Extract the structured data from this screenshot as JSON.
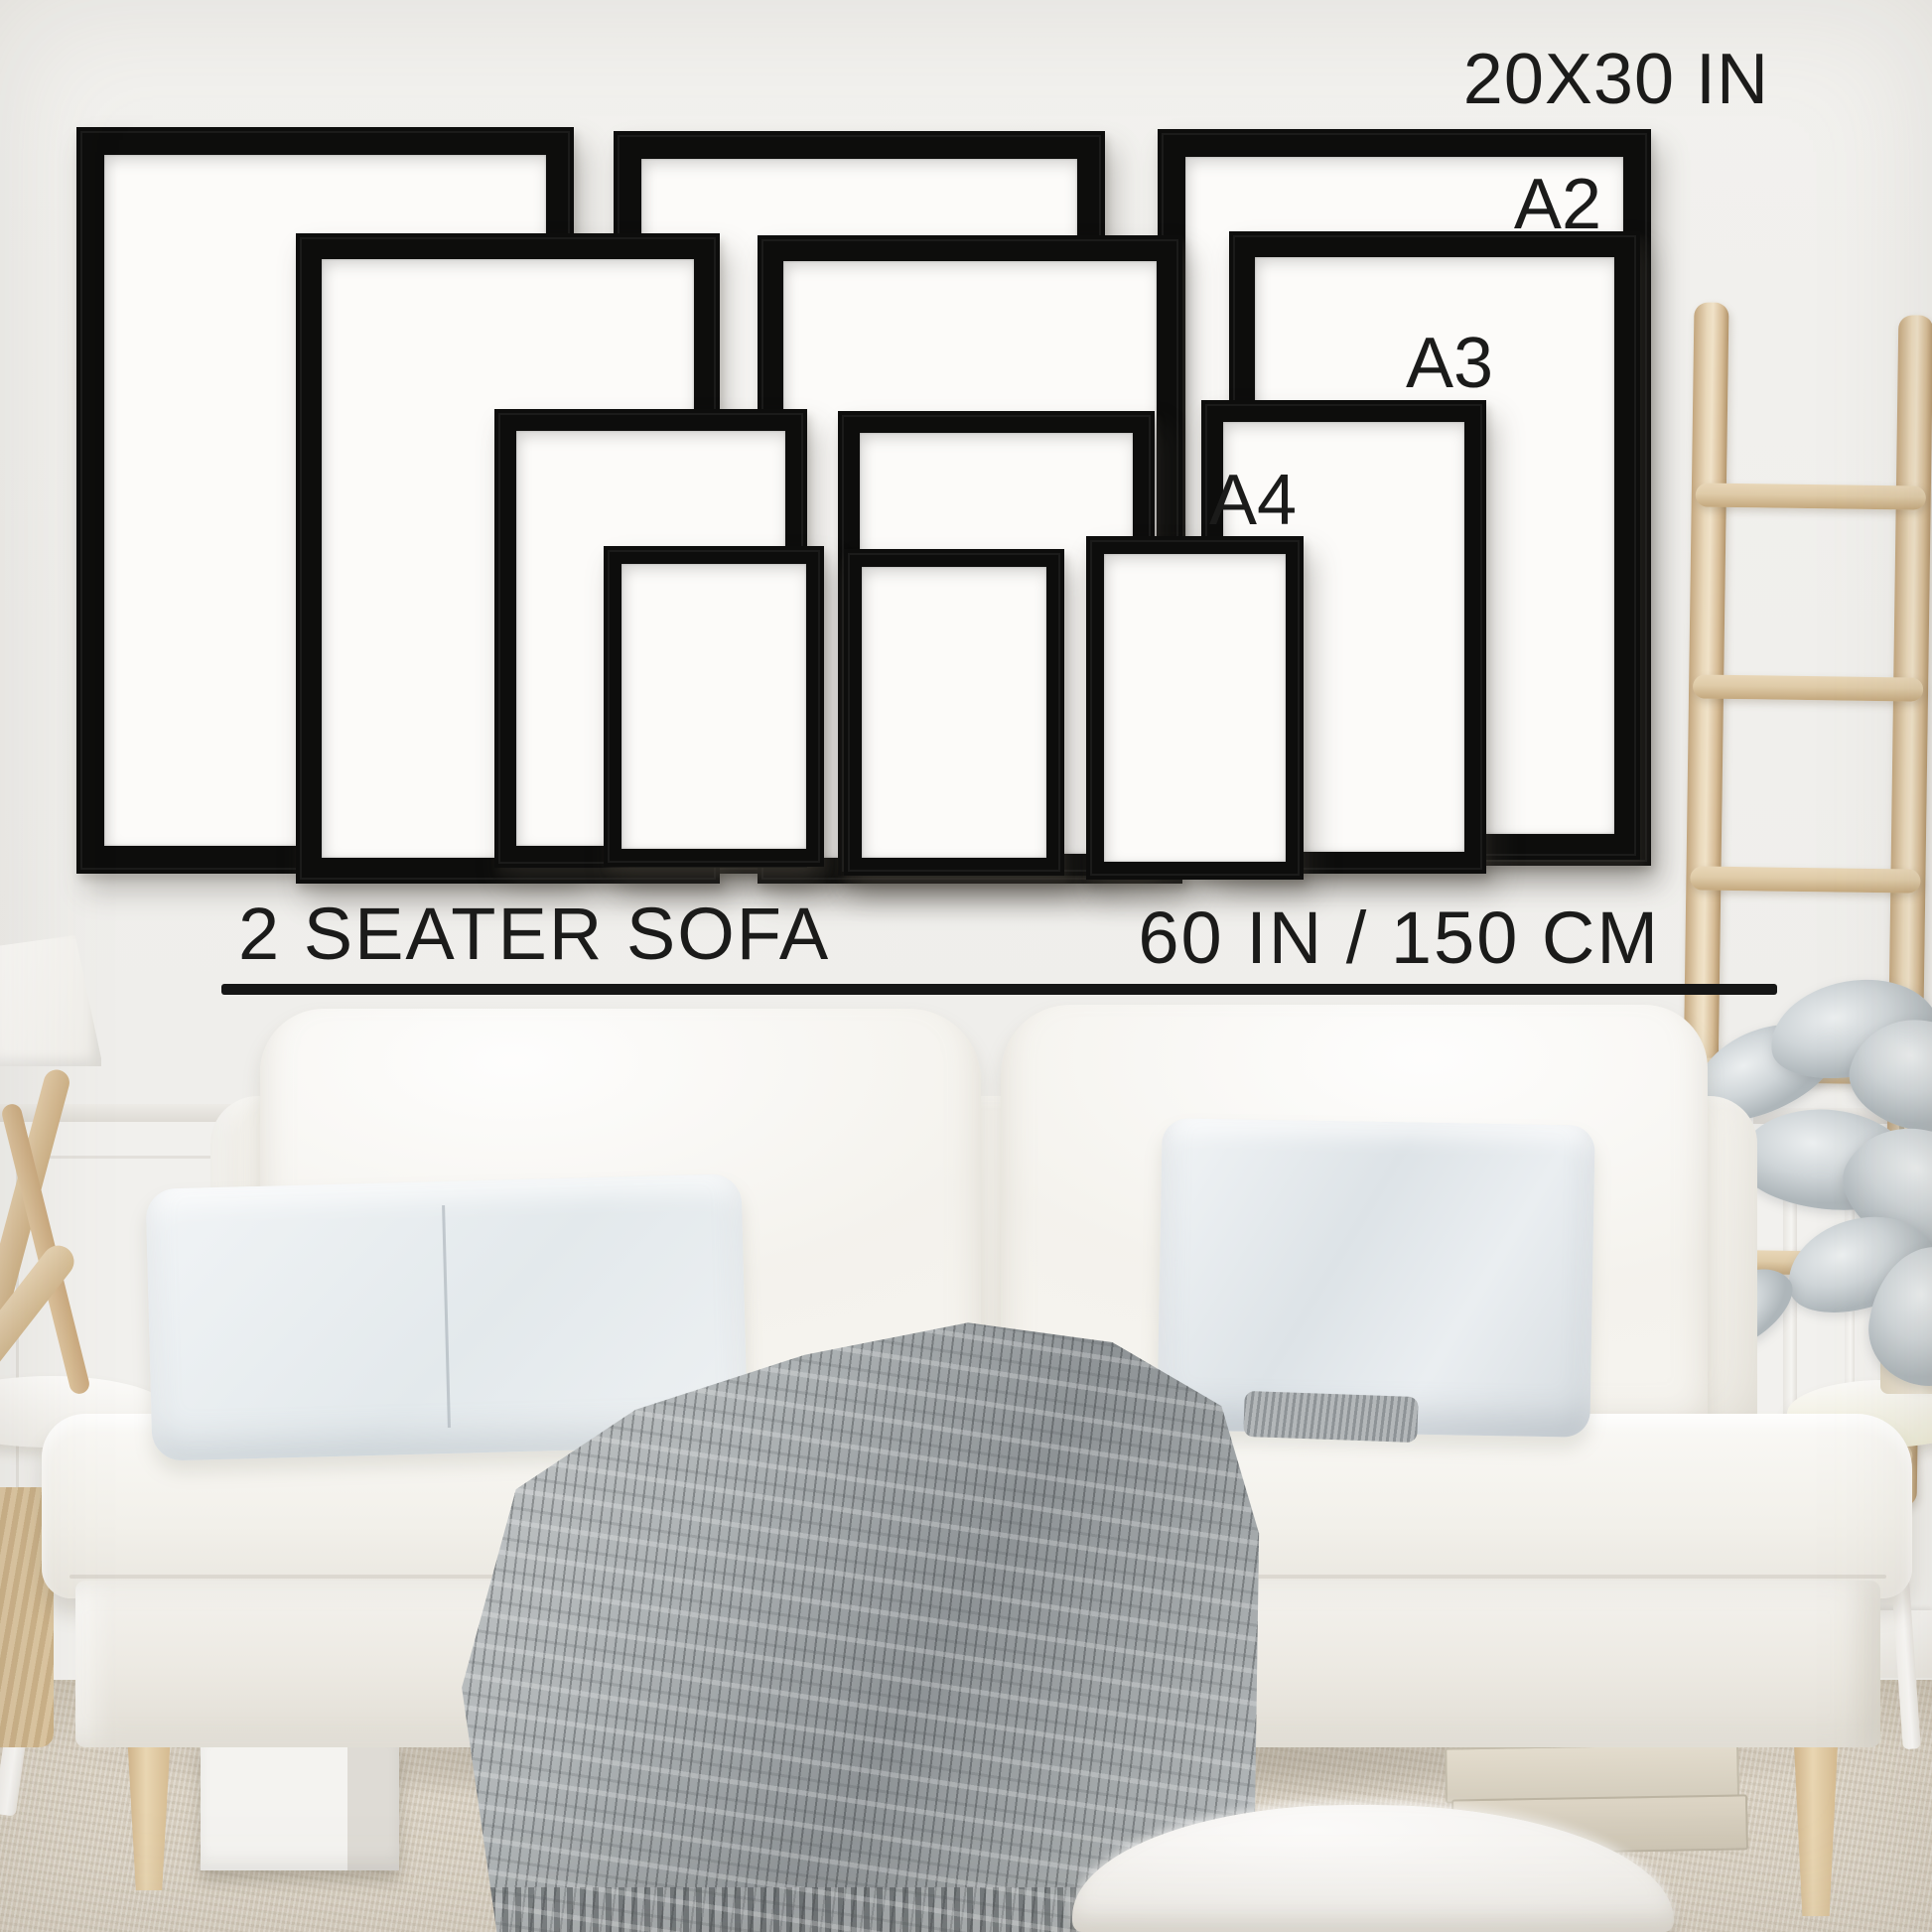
{
  "labels": {
    "size_top": "20X30 IN",
    "size_a2": "A2",
    "size_a3": "A3",
    "size_a4": "A4",
    "sofa": "2 SEATER SOFA",
    "sofa_width": "60 IN / 150 CM"
  },
  "frames": {
    "sizes": [
      {
        "label": "20X30 IN",
        "count": 3
      },
      {
        "label": "A2",
        "count": 3
      },
      {
        "label": "A3",
        "count": 3
      },
      {
        "label": "A4",
        "count": 3
      }
    ],
    "total": 12,
    "frame_color": "#0d0d0c",
    "paper_color": "#fcfbf9"
  },
  "colors": {
    "wall": "#f0efec",
    "text": "#1b1b1a",
    "underline": "#161616",
    "sofa_fabric": "#f6f4f0",
    "pillow_gray": "#e9edf0",
    "blanket_gray": "#9ba0a3",
    "ladder_wood": "#dfc6a4",
    "carpet": "#d6cdbe"
  }
}
